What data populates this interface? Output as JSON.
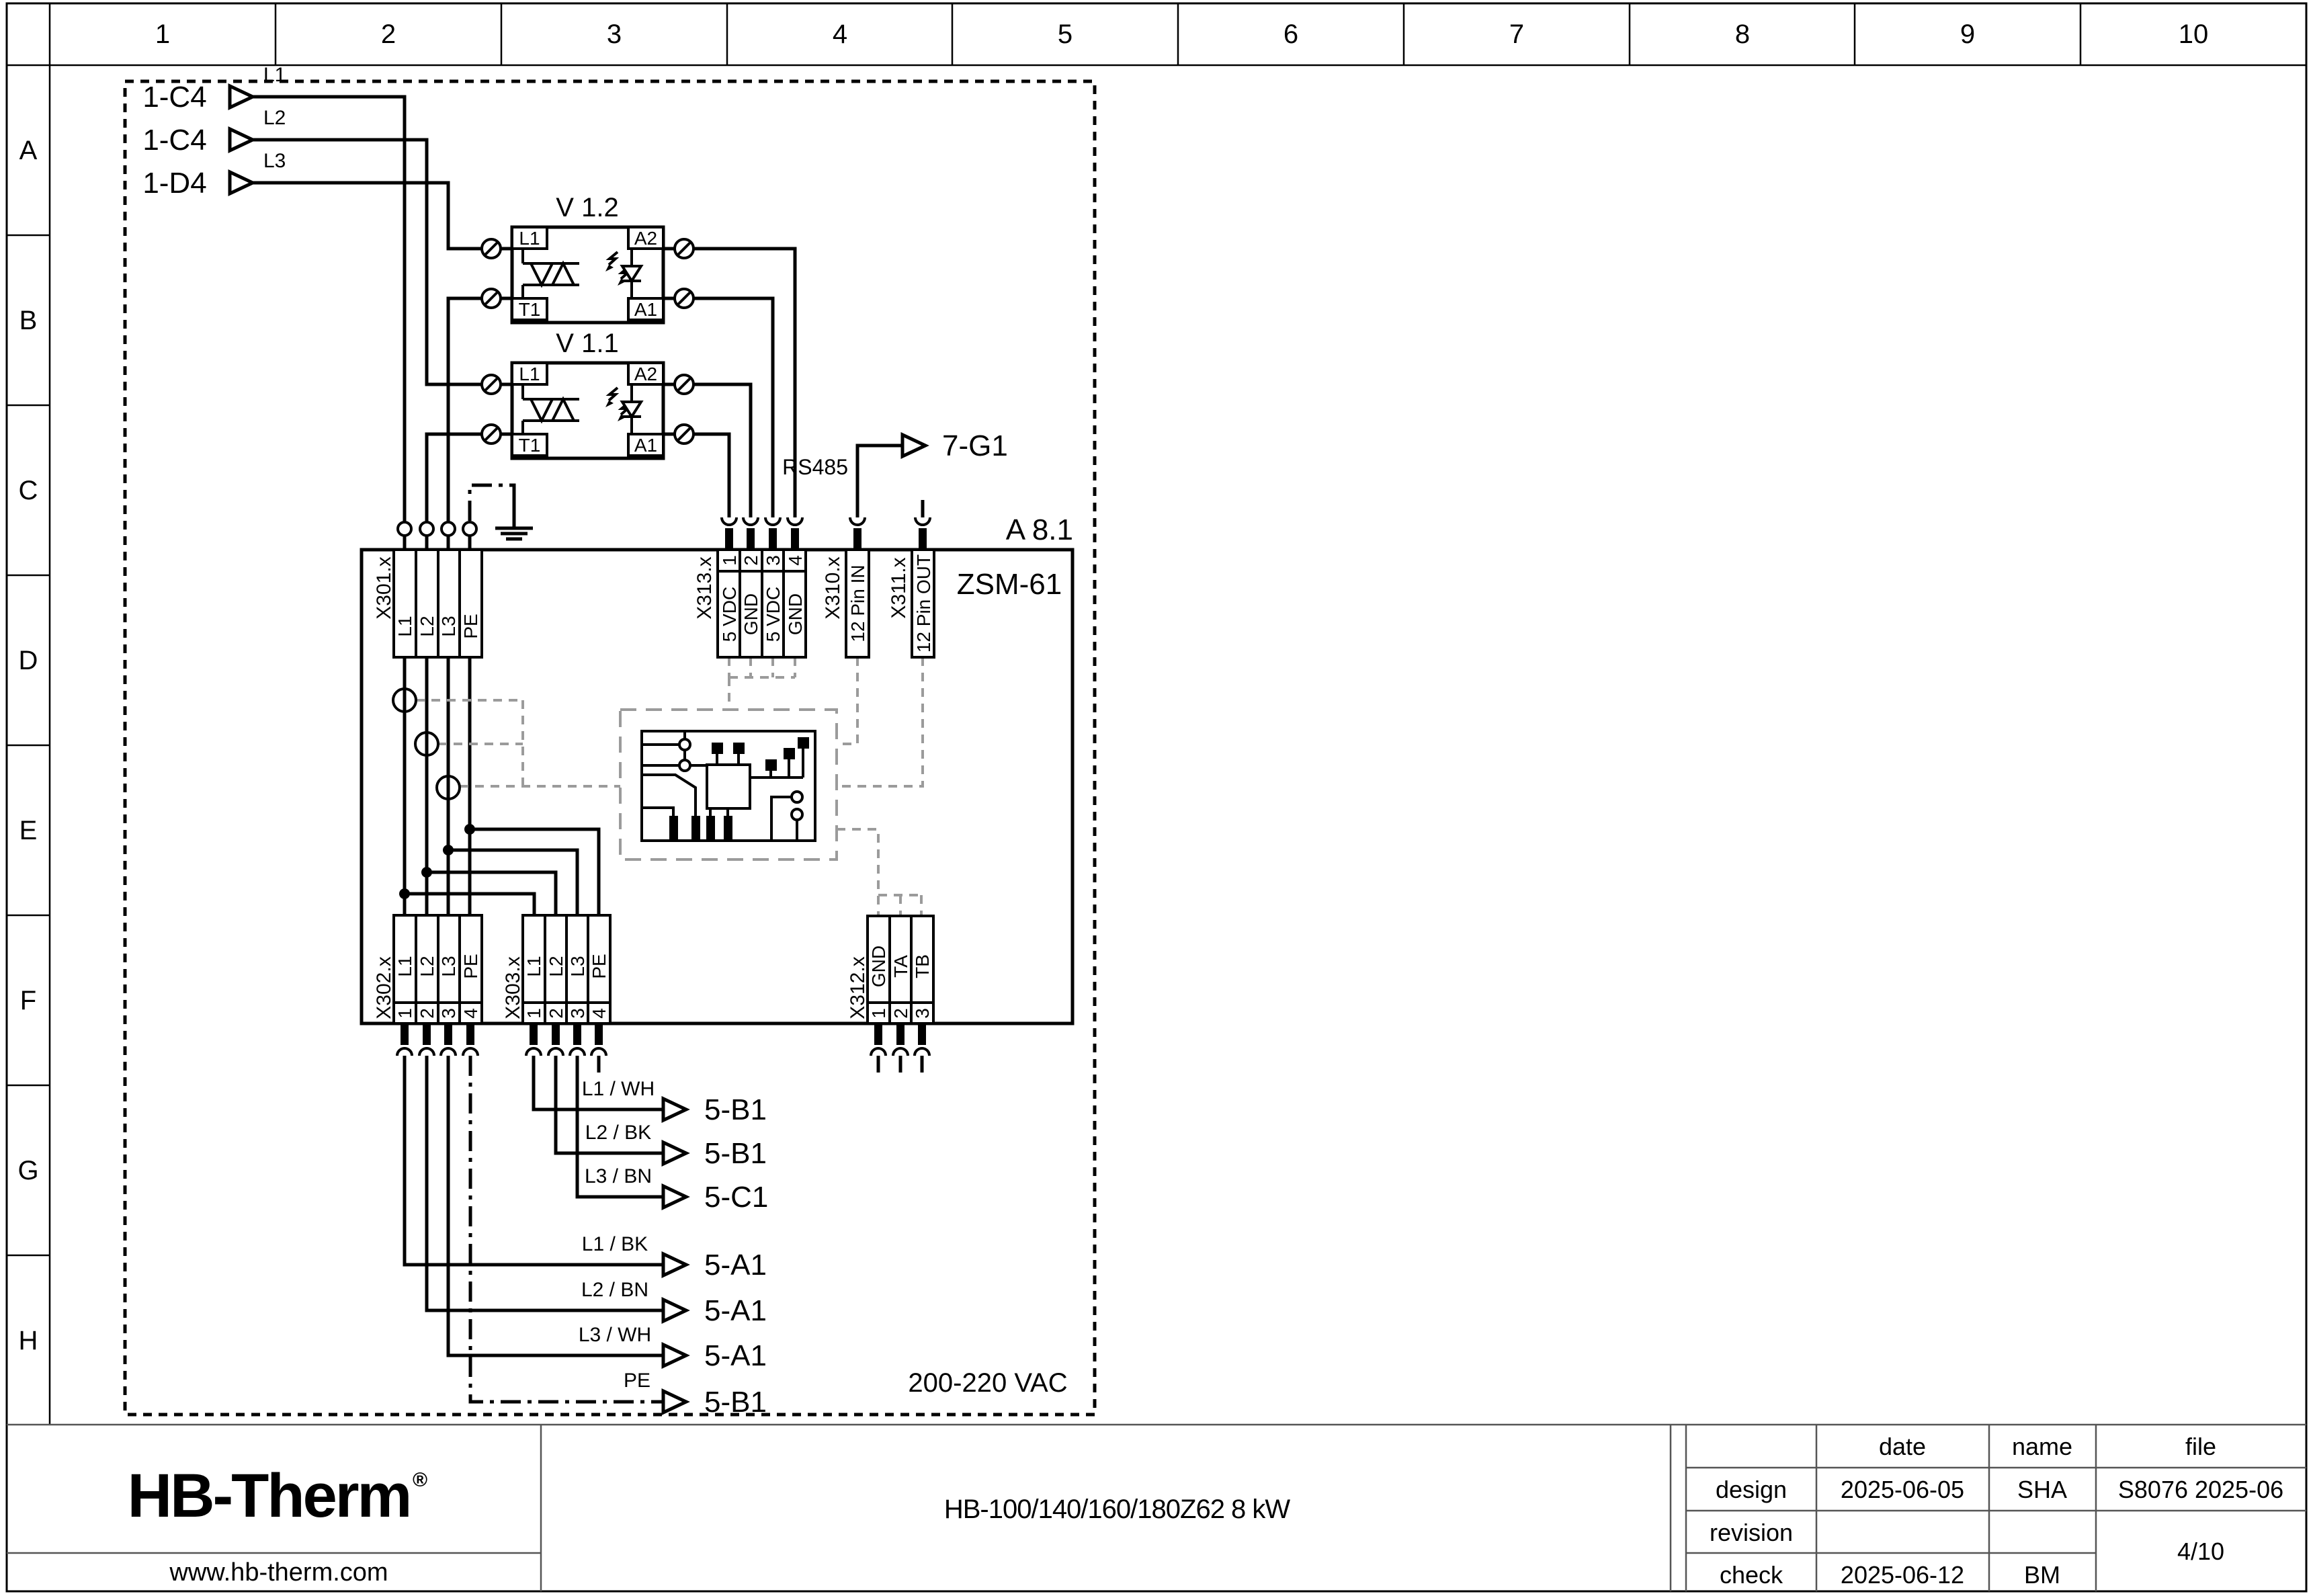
{
  "colors": {
    "logo": "#1b2a4a",
    "line": "#000000",
    "aux_dashed": "#9b9b9b"
  },
  "grid": {
    "cols": [
      "1",
      "2",
      "3",
      "4",
      "5",
      "6",
      "7",
      "8",
      "9",
      "10"
    ],
    "rows": [
      "A",
      "B",
      "C",
      "D",
      "E",
      "F",
      "G",
      "H"
    ]
  },
  "inputs": [
    {
      "tag": "1-C4",
      "phase": "L1"
    },
    {
      "tag": "1-C4",
      "phase": "L2"
    },
    {
      "tag": "1-D4",
      "phase": "L3"
    }
  ],
  "v12": {
    "title": "V 1.2",
    "l1": "L1",
    "t1": "T1",
    "a2": "A2",
    "a1": "A1"
  },
  "v11": {
    "title": "V 1.1",
    "l1": "L1",
    "t1": "T1",
    "a2": "A2",
    "a1": "A1"
  },
  "comm": {
    "bus": "RS485",
    "target": "7-G1"
  },
  "module": {
    "ref": "A 8.1",
    "name": "ZSM-61",
    "voltage": "200-220 VAC"
  },
  "terminals": {
    "x301": {
      "label": "X301.x",
      "cells": [
        "L1",
        "L2",
        "L3",
        "PE"
      ]
    },
    "x313": {
      "label": "X313.x",
      "numbers": [
        "1",
        "2",
        "3",
        "4"
      ],
      "cells": [
        "5 VDC",
        "GND",
        "5 VDC",
        "GND"
      ]
    },
    "x310": {
      "label": "X310.x",
      "pin": "12 Pin IN"
    },
    "x311": {
      "label": "X311.x",
      "pin": "12 Pin OUT"
    },
    "x302": {
      "label": "X302.x",
      "numbers": [
        "1",
        "2",
        "3",
        "4"
      ],
      "cells": [
        "L1",
        "L2",
        "L3",
        "PE"
      ]
    },
    "x303": {
      "label": "X303.x",
      "numbers": [
        "1",
        "2",
        "3",
        "4"
      ],
      "cells": [
        "L1",
        "L2",
        "L3",
        "PE"
      ]
    },
    "x312": {
      "label": "X312.x",
      "numbers": [
        "1",
        "2",
        "3"
      ],
      "cells": [
        "GND",
        "TA",
        "TB"
      ]
    }
  },
  "outputs": {
    "g": [
      {
        "label": "L1 / WH",
        "tag": "5-B1"
      },
      {
        "label": "L2 / BK",
        "tag": "5-B1"
      },
      {
        "label": "L3 / BN",
        "tag": "5-C1"
      }
    ],
    "h": [
      {
        "label": "L1 / BK",
        "tag": "5-A1"
      },
      {
        "label": "L2 / BN",
        "tag": "5-A1"
      },
      {
        "label": "L3 / WH",
        "tag": "5-A1"
      },
      {
        "label": "PE",
        "tag": "5-B1"
      }
    ]
  },
  "title_block": {
    "logo": "HB-Therm",
    "reg": "®",
    "website": "www.hb-therm.com",
    "title": "HB-100/140/160/180Z62 8 kW",
    "table": {
      "headers": {
        "date": "date",
        "name": "name",
        "file": "file"
      },
      "rows": [
        {
          "label": "design",
          "date": "2025-06-05",
          "name": "SHA",
          "file": "S8076 2025-06"
        },
        {
          "label": "revision",
          "date": "",
          "name": "",
          "file": ""
        },
        {
          "label": "check",
          "date": "2025-06-12",
          "name": "BM",
          "file": ""
        }
      ],
      "page": "4/10"
    }
  }
}
